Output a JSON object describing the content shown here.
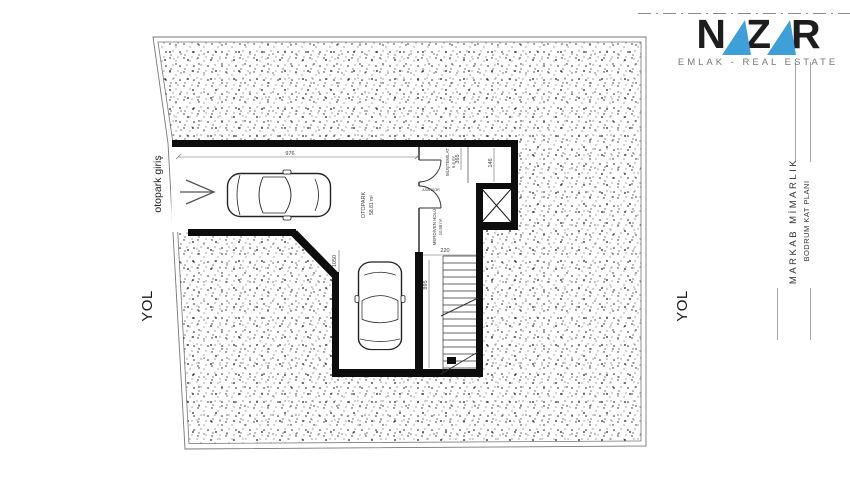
{
  "logo": {
    "letters": [
      "N",
      "A",
      "Z",
      "A",
      "R"
    ],
    "subtitle": "EMLAK - REAL ESTATE",
    "accent_color": "#3f9fd8",
    "text_color": "#1d1d1f"
  },
  "title_block": {
    "firm": "MARKAB MİMARLIK",
    "drawing": "BODRUM KAT PLANI"
  },
  "surroundings": {
    "road_left": "YOL",
    "road_right": "YOL",
    "entrance": "otopark giriş"
  },
  "plan": {
    "rooms": {
      "garage": {
        "name": "OTOPARK",
        "area": "58.81 m²"
      },
      "utility": {
        "name": "MÜŞTEMİLAT",
        "area": "6.6 m²"
      },
      "stair_hall": {
        "name": "MERDİVEN HOLÜ",
        "area": "10.58 m²"
      },
      "elevator": {
        "name": "ASANSÖR"
      }
    },
    "dimensions": {
      "garage_width": "976",
      "utility_w": "365",
      "utility_right": "146",
      "stair_width": "220",
      "stair_depth": "895",
      "garage_depth": "1050"
    }
  },
  "colors": {
    "wall": "#0d0d0d",
    "line": "#555555",
    "stipple": "#1a1a1a"
  }
}
